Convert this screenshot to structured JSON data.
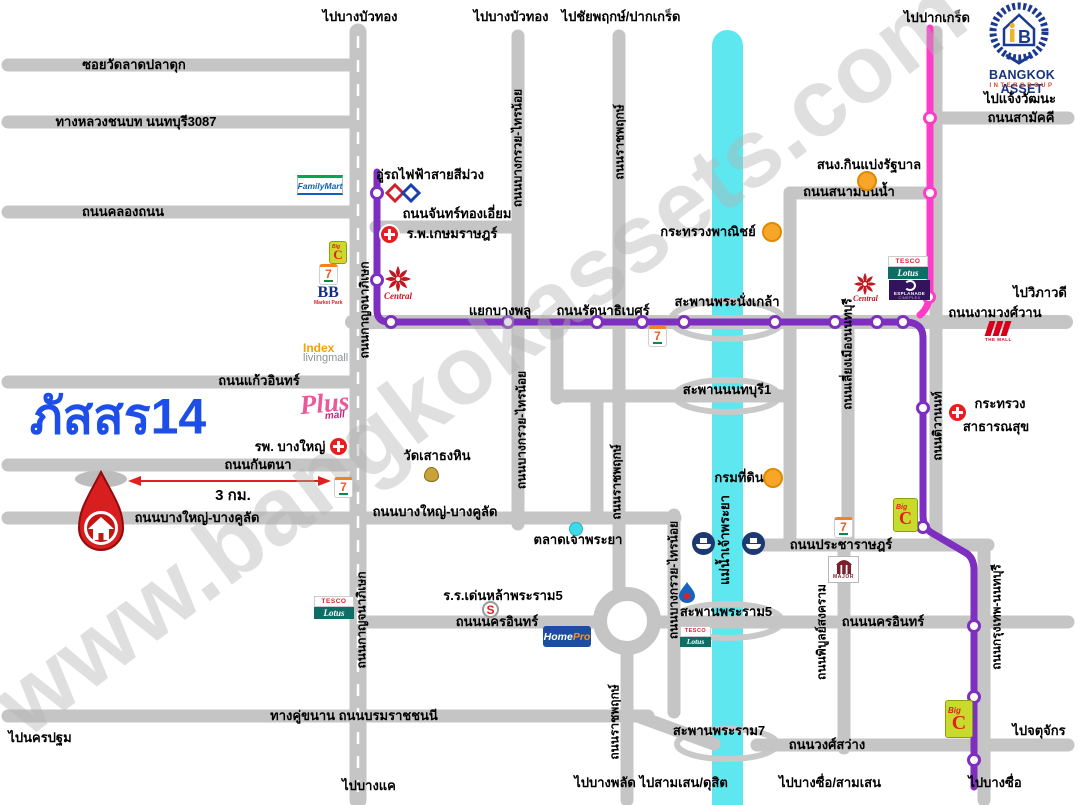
{
  "project": {
    "name": "ภัสสร14",
    "distance": "3 กม."
  },
  "brand_logo": {
    "name": "BANGKOK ASSET",
    "subtitle": "INTERGROUP",
    "monogram": "B"
  },
  "watermark": "www.bangkokassets.com",
  "directions": {
    "bang_bua_thong_1": "ไปบางบัวทอง",
    "bang_bua_thong_2": "ไปบางบัวทอง",
    "chaiyaphruek_pak_kret": "ไปชัยพฤกษ์/ปากเกร็ด",
    "pak_kret": "ไปปากเกร็ด",
    "chaeng_watthana": "ไปแจ้งวัฒนะ",
    "wiphawadi": "ไปวิภาวดี",
    "nakhon_pathom": "ไปนครปฐม",
    "bang_khae": "ไปบางแค",
    "bang_phlat_samsen_dusit": "ไปบางพลัด ไปสามเสน/ดุสิต",
    "bang_sue_samsen": "ไปบางซื่อ/สามเสน",
    "chatuchak": "ไปจตุจักร",
    "bang_sue": "ไปบางซื่อ"
  },
  "roads": {
    "soi_wat_lat_pla_duk": "ซอยวัดลาดปลาดุก",
    "rural_highway_3087": "ทางหลวงชนบท นนทบุรี3087",
    "khlong_thanon": "ถนนคลองถนน",
    "chan_thong_iam": "ถนนจันทร์ทองเอี่ยม",
    "yaek_bang_phlu": "แยกบางพลู",
    "rattanathibet": "ถนนรัตนาธิเบศร์",
    "ngam_wong_wan": "ถนนงามวงศ์วาน",
    "kaeo_in": "ถนนแก้วอินทร์",
    "kantana": "ถนนกันตนา",
    "bang_yai_bang_khulat_1": "ถนนบางใหญ่-บางคูลัด",
    "bang_yai_bang_khulat_2": "ถนนบางใหญ่-บางคูลัด",
    "samakkhi": "ถนนสามัคคี",
    "sanam_bin_nam": "ถนนสนามบินน้ำ",
    "pracharat": "ถนนประชาราษฎร์",
    "nakhon_in_west": "ถนนนครอินทร์",
    "nakhon_in_east": "ถนนนครอินทร์",
    "borommaratchachonnani": "ทางคู่ขนาน ถนนบรมราชชนนี",
    "wong_sawang": "ถนนวงศ์สว่าง",
    "kanchanaphisek_1": "ถนนกาญจนาภิเษก",
    "kanchanaphisek_2": "ถนนกาญจนาภิเษก",
    "bang_kruai_sai_noi_1": "ถนนบางกรวย-ไทรน้อย",
    "bang_kruai_sai_noi_2": "ถนนบางกรวย-ไทรน้อย",
    "bang_kruai_sai_noi_3": "ถนนบางกรวย-ไทรน้อย",
    "ratchaphruek_1": "ถนนราชพฤกษ์",
    "ratchaphruek_2": "ถนนราชพฤกษ์",
    "ratchaphruek_3": "ถนนราชพฤกษ์",
    "liang_mueang_nonthaburi": "ถนนเลี่ยงเมืองนนทบุรี",
    "tiwanon": "ถนนติวานนท์",
    "phibun_songkhram": "ถนนพิบูลย์สงคราม",
    "krungthep_nonthaburi": "ถนนกรุงเทพ-นนทบุรี"
  },
  "bridges": {
    "phra_nangklao": "สะพานพระนั่งเกล้า",
    "nonthaburi_1": "สะพานนนทบุรี1",
    "phra_ram_5": "สะพานพระราม5",
    "phra_ram_7": "สะพานพระราม7"
  },
  "river": {
    "name": "แม่น้ำเจ้าพระยา"
  },
  "places": {
    "purple_line_depot": "อู่รถไฟฟ้าสายสีม่วง",
    "kasemrad_hospital": "ร.พ.เกษมราษฎร์",
    "lottery_office": "สนง.กินแบ่งรัฐบาล",
    "ministry_of_commerce": "กระทรวงพาณิชย์",
    "ministry_of_health_line1": "กระทรวง",
    "ministry_of_health_line2": "สาธารณสุข",
    "wat_sao_thong_hin": "วัดเสาธงหิน",
    "bang_yai_hospital": "รพ. บางใหญ่",
    "chao_phraya_market": "ตลาดเจ้าพระยา",
    "land_department": "กรมที่ดิน",
    "denla_phra_ram5_school": "ร.ร.เด่นหล้าพระราม5"
  },
  "brands": {
    "familymart": "FamilyMart",
    "seven_eleven": "7",
    "big_c_big": "Big",
    "big_c_c": "C",
    "bb": "BB",
    "bb_sub": "Market Park",
    "central": "Central",
    "tesco": "TESCO",
    "lotus": "Lotus",
    "esplanade": "ESPLANADE",
    "esplanade_sub": "CINEPLEX",
    "index": "Index",
    "index_sub": "livingmall",
    "plus": "Plus",
    "plus_sub": "mall",
    "the_mall": "THE MALL",
    "homepro_home": "Home",
    "homepro_pro": "Pro",
    "major": "MAJOR",
    "school_s": "S"
  },
  "colors": {
    "road": "#c5c5c5",
    "river": "#5ee7ef",
    "mrt_purple": "#7e2fc0",
    "mrt_pink": "#ff3cc8",
    "pin_red": "#d81e1e",
    "project_blue": "#1e4ee8",
    "poi_orange": "#f7a62a"
  }
}
